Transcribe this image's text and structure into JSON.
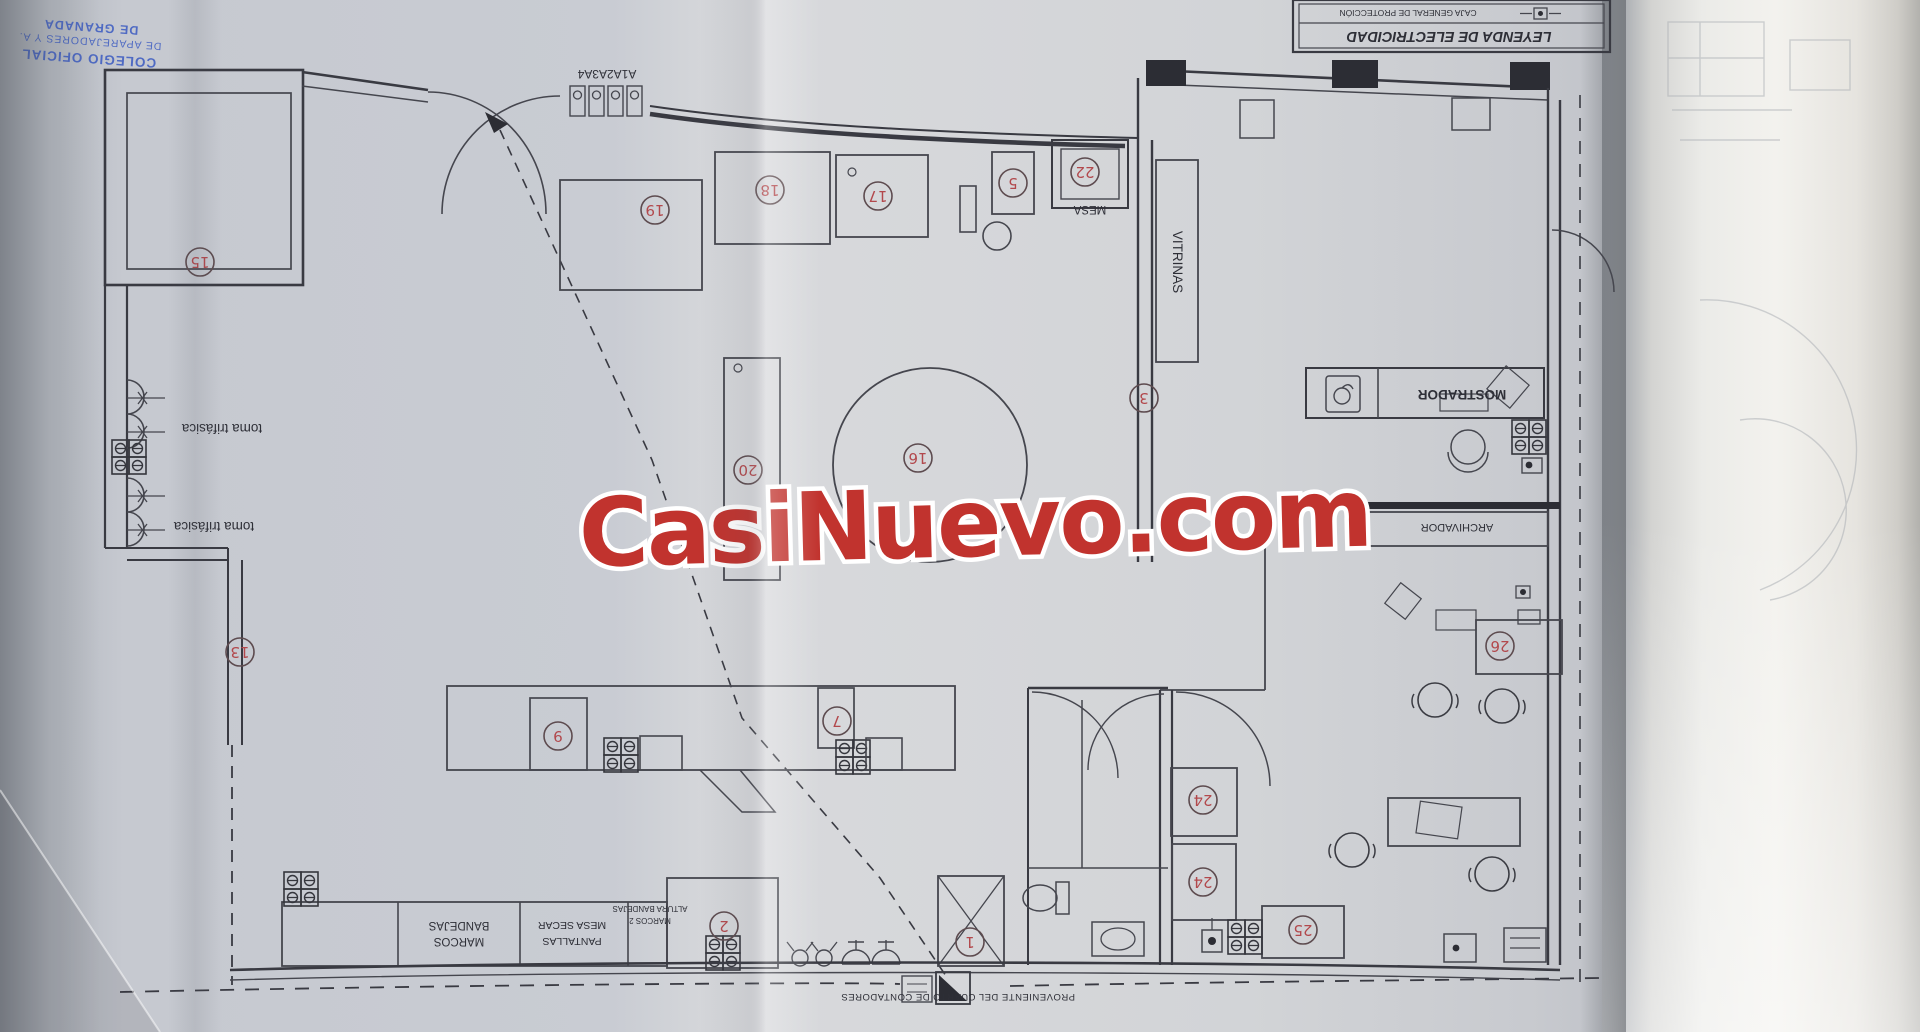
{
  "watermark": {
    "text": "CasiNuevo.com",
    "color": "#c1332e"
  },
  "stamp": {
    "color": "#3f5ec2",
    "line1": "COLEGIO OFICIAL",
    "line2": "DE APAREJADORES Y A.",
    "line3": "DE GRANADA"
  },
  "legend": {
    "title": "LEYENDA  DE  ELECTRICIDAD",
    "row1": "CAJA GENERAL DE PROTECCIÓN"
  },
  "plan": {
    "labels": {
      "panel": "A1A2A3A4",
      "mesa": "MESA",
      "vitrinas": "VITRINAS",
      "mostrador": "MOSTRADOR",
      "archivador": "ARCHIVADOR",
      "toma1": "toma trifásica",
      "toma2": "toma trifásica",
      "bandejas_l1": "BANDEJAS",
      "bandejas_l2": "MARCOS",
      "secar_l1": "MESA SECAR",
      "secar_l2": "PANTALLAS",
      "altura_l1": "ALTURA BANDEJAS",
      "altura_l2": "MARCOS 2",
      "proveniente": "PROVENIENTE DEL CUARTO DE CONTADORES"
    },
    "circles": [
      {
        "n": "15",
        "x": 200,
        "y": 262
      },
      {
        "n": "13",
        "x": 240,
        "y": 652
      },
      {
        "n": "19",
        "x": 655,
        "y": 210
      },
      {
        "n": "18",
        "x": 770,
        "y": 190
      },
      {
        "n": "17",
        "x": 878,
        "y": 196
      },
      {
        "n": "5",
        "x": 1013,
        "y": 183
      },
      {
        "n": "22",
        "x": 1085,
        "y": 172
      },
      {
        "n": "16",
        "x": 918,
        "y": 458
      },
      {
        "n": "20",
        "x": 748,
        "y": 470
      },
      {
        "n": "3",
        "x": 1144,
        "y": 398
      },
      {
        "n": "9",
        "x": 558,
        "y": 736
      },
      {
        "n": "7",
        "x": 837,
        "y": 721
      },
      {
        "n": "2",
        "x": 724,
        "y": 926
      },
      {
        "n": "1",
        "x": 970,
        "y": 942
      },
      {
        "n": "24",
        "x": 1203,
        "y": 800
      },
      {
        "n": "24",
        "x": 1203,
        "y": 882
      },
      {
        "n": "25",
        "x": 1303,
        "y": 930
      },
      {
        "n": "26",
        "x": 1500,
        "y": 646
      }
    ]
  }
}
